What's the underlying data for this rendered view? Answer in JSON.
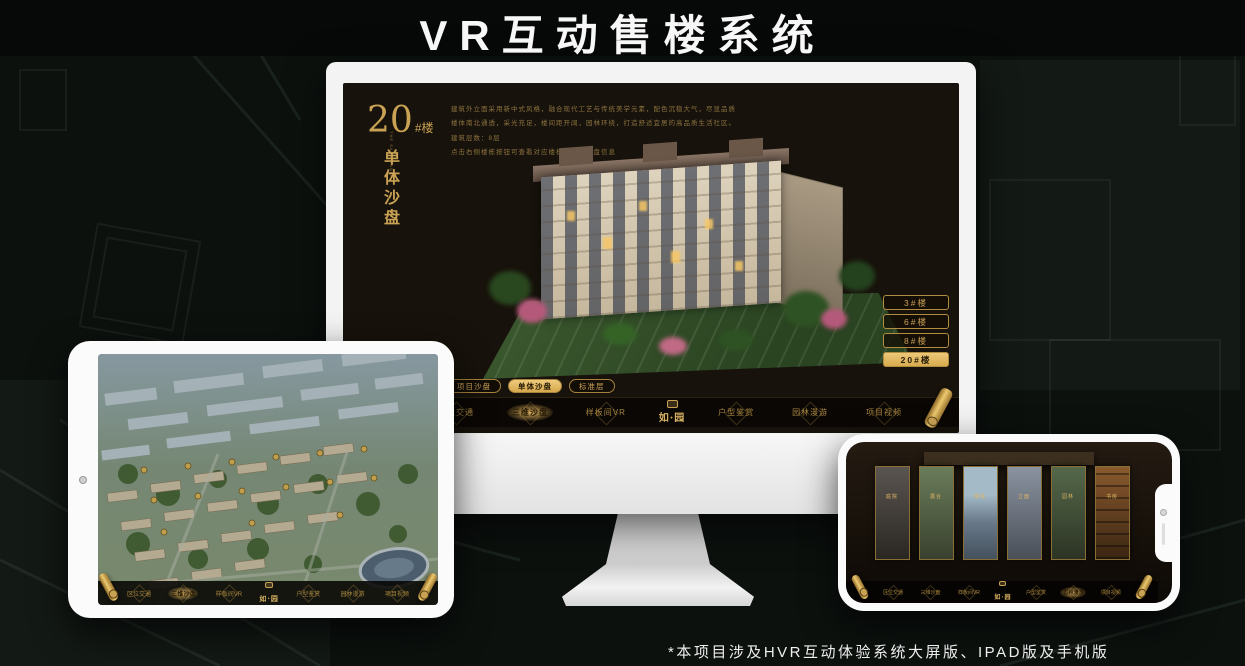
{
  "page": {
    "title": "VR互动售楼系统",
    "footnote": "*本项目涉及HVR互动体验系统大屏版、IPAD版及手机版"
  },
  "colors": {
    "gold": "#c9a254",
    "gold_bright": "#e0b663",
    "screen_bg": "#17120b",
    "nav_bg": "#0a0704",
    "background": "#0c110e"
  },
  "monitor": {
    "panel": {
      "title_number": "20",
      "title_suffix": "#楼",
      "subtitle_en": "THE SAND TABLE",
      "subtitle_cn": "单体沙盘"
    },
    "description_lines": [
      "建筑外立面采用新中式风格，融合现代工艺与传统美学元素，配色沉稳大气，尽显品质",
      "楼体南北通透，采光充足，楼间距开阔，园林环绕，打造舒适宜居的高品质生活社区。",
      "建筑层数：8层",
      "点击右侧楼栋按钮可查看对应楼栋的单体沙盘信息"
    ],
    "floor_buttons": [
      {
        "label": "3#楼",
        "selected": false
      },
      {
        "label": "6#楼",
        "selected": false
      },
      {
        "label": "8#楼",
        "selected": false
      },
      {
        "label": "20#楼",
        "selected": true
      }
    ],
    "view_tabs": [
      {
        "label": "项目沙盘",
        "selected": false
      },
      {
        "label": "单体沙盘",
        "selected": true
      },
      {
        "label": "标准层",
        "selected": false
      }
    ],
    "nav": {
      "logo": "如·园",
      "items": [
        {
          "label": "区位交通",
          "selected": false
        },
        {
          "label": "三维沙盘",
          "selected": true
        },
        {
          "label": "样板间VR",
          "selected": false
        },
        {
          "label": "户型鉴赏",
          "selected": false
        },
        {
          "label": "园林漫游",
          "selected": false
        },
        {
          "label": "项目视频",
          "selected": false
        }
      ]
    }
  },
  "tablet": {
    "nav": {
      "logo": "如·园",
      "items": [
        {
          "label": "区位交通",
          "selected": false
        },
        {
          "label": "三维沙盘",
          "selected": true
        },
        {
          "label": "样板间VR",
          "selected": false
        },
        {
          "label": "户型鉴赏",
          "selected": false
        },
        {
          "label": "园林漫游",
          "selected": false
        },
        {
          "label": "项目视频",
          "selected": false
        }
      ]
    }
  },
  "phone": {
    "panels": [
      {
        "caption": "庭院"
      },
      {
        "caption": "露台"
      },
      {
        "caption": "楼栋"
      },
      {
        "caption": "立面"
      },
      {
        "caption": "园林"
      },
      {
        "caption": "书房"
      }
    ],
    "nav": {
      "logo": "如·园",
      "items": [
        {
          "label": "区位交通",
          "selected": false
        },
        {
          "label": "三维沙盘",
          "selected": false
        },
        {
          "label": "样板间VR",
          "selected": false
        },
        {
          "label": "户型鉴赏",
          "selected": false
        },
        {
          "label": "园林漫游",
          "selected": true
        },
        {
          "label": "项目视频",
          "selected": false
        }
      ]
    }
  }
}
